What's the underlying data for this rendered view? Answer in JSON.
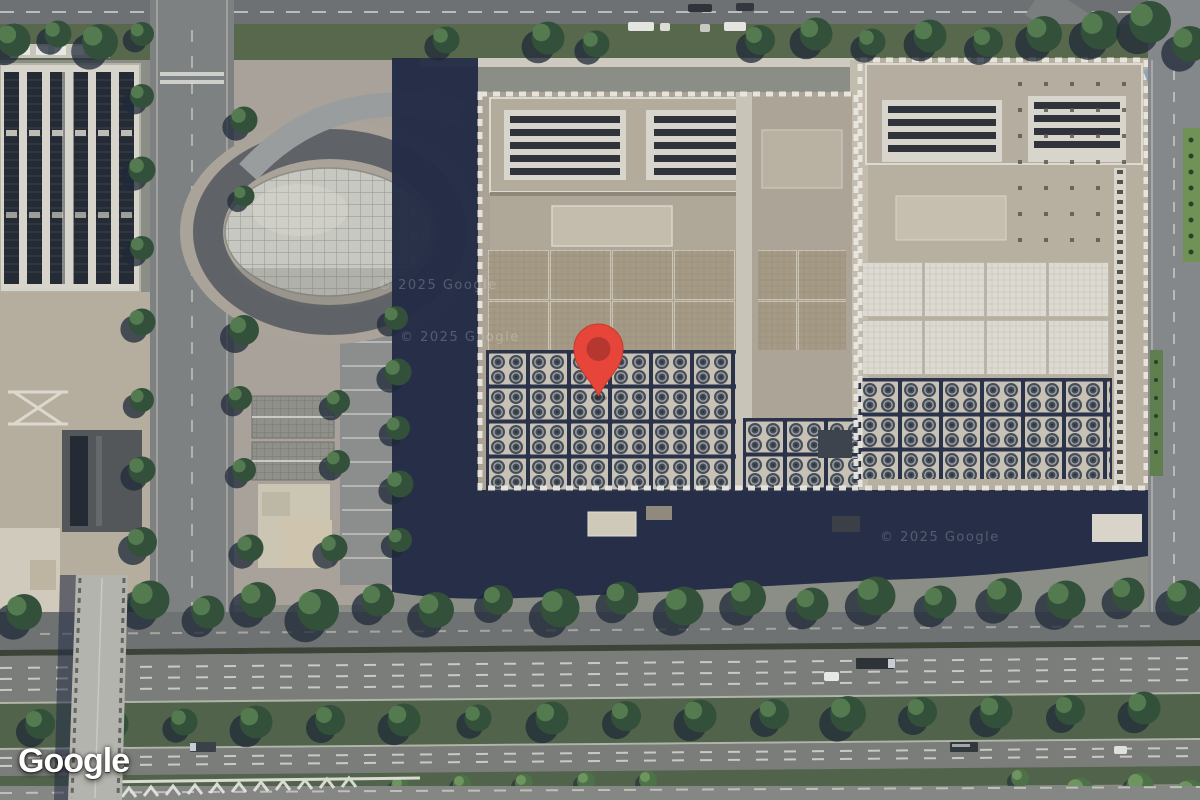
{
  "attribution": {
    "logo_text": "Google"
  },
  "watermark": {
    "text": "© 2025 Google"
  },
  "marker": {
    "icon": "map-pin-icon",
    "color": "#E8453A",
    "inner_color": "#B63730"
  },
  "colors": {
    "pin": "#E8453A",
    "pin_inner": "#B63730",
    "pin_edge": "#C23B30",
    "shadow_navy": "#232C45",
    "roof_left": "#A9A295",
    "roof_right": "#B7B0A0",
    "panel_tan": "#A59A85",
    "panel_white": "#DDDAD1",
    "rim_white": "#E9E7DF",
    "hvac_block": "#C7C2B5",
    "fan_dark": "#464D57",
    "asphalt": "#7A7D79",
    "road_gray": "#7E8182",
    "grass": "#51634A",
    "tree_dark": "#33503A",
    "tree_light": "#5B8254",
    "tree_shadow": "#1F2A38",
    "dome_gray": "#C8C8C2",
    "solar_dark": "#252B34",
    "plaza_beige": "#B5AE9E",
    "logo_white": "#FFFFFF"
  }
}
